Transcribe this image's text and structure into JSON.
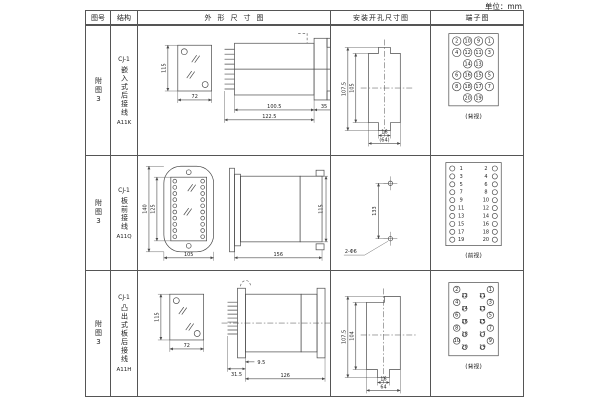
{
  "unit_label": "单位：mm",
  "header": {
    "col_fig": "图号",
    "col_structure": "结构",
    "col_outline": "外形尺寸图",
    "col_install": "安装开孔尺寸图",
    "col_terminal": "端子图"
  },
  "rows": [
    {
      "fig_no": "附图3",
      "structure": {
        "model": "CJ-1",
        "mounting": "嵌入式后接线",
        "code": "A11K"
      },
      "outline": {
        "front_height": "115",
        "front_width": "72",
        "body_depth": "100.5",
        "total_depth": "122.5",
        "flange_depth": "35"
      },
      "install": {
        "outer_height": "107.5",
        "inner_height": "105",
        "slot_width": "16",
        "overall_width": "(64)"
      },
      "terminal": {
        "view_label": "(背视)",
        "grid": [
          [
            "2",
            "10",
            "9",
            "1"
          ],
          [
            "4",
            "12",
            "11",
            "3"
          ],
          [
            "",
            "14",
            "13",
            ""
          ],
          [
            "6",
            "16",
            "15",
            "5"
          ],
          [
            "8",
            "18",
            "17",
            "7"
          ],
          [
            "",
            "20",
            "19",
            ""
          ]
        ]
      }
    },
    {
      "fig_no": "附图3",
      "structure": {
        "model": "CJ-1",
        "mounting": "板前接线",
        "code": "A11Q"
      },
      "outline": {
        "outer_height": "140",
        "inner_height": "125",
        "front_width": "105",
        "total_length": "156",
        "side_height": "115"
      },
      "install": {
        "hole_spacing": "133",
        "hole_label": "2-Φ6"
      },
      "terminal": {
        "view_label": "(前视)",
        "left_numbers": [
          "1",
          "3",
          "5",
          "7",
          "9",
          "11",
          "13",
          "15",
          "17",
          "19"
        ],
        "right_numbers": [
          "2",
          "4",
          "6",
          "8",
          "10",
          "12",
          "14",
          "16",
          "18",
          "20"
        ]
      }
    },
    {
      "fig_no": "附图3",
      "structure": {
        "model": "CJ-1",
        "mounting": "凸出式板后接线",
        "code": "A11H"
      },
      "outline": {
        "front_height": "115",
        "front_width": "72",
        "pin_depth": "31.5",
        "flange_offset": "9.5",
        "body_length": "126"
      },
      "install": {
        "outer_height": "107.5",
        "inner_height": "104",
        "slot_width": "16",
        "overall_width": "64"
      },
      "terminal": {
        "view_label": "(背视)",
        "left_outer": [
          "2",
          "4",
          "6",
          "8",
          "10"
        ],
        "left_inner": [
          "12",
          "14",
          "16",
          "18",
          "20"
        ],
        "right_outer": [
          "1",
          "3",
          "5",
          "7",
          "9"
        ],
        "right_inner": [
          "11",
          "13",
          "15",
          "17",
          "19"
        ]
      }
    }
  ],
  "colors": {
    "line": "#4a4a4a",
    "text": "#222222",
    "border": "#555555",
    "background": "#ffffff"
  }
}
